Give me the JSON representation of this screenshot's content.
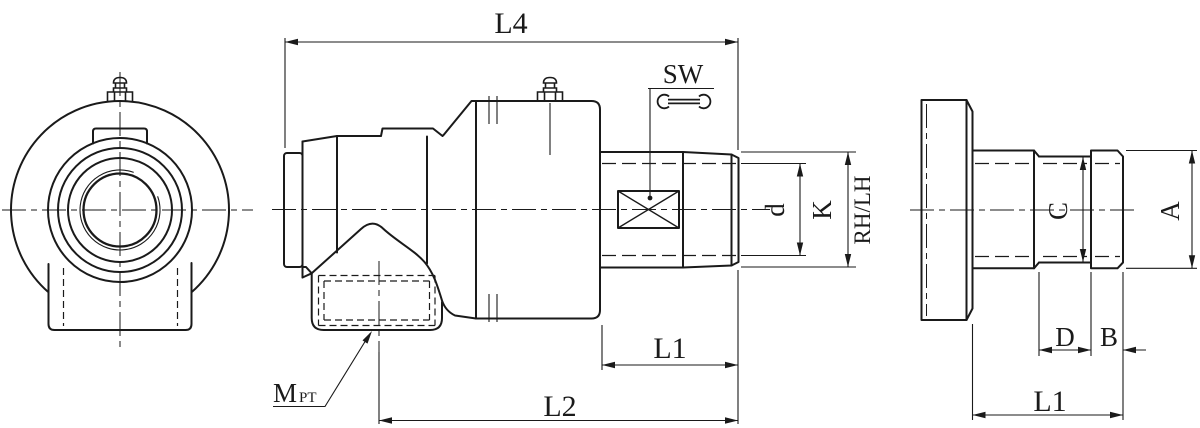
{
  "drawing": {
    "type": "engineering-drawing",
    "subject": "rotary joint with threaded shaft, front view, side view and nipple end view",
    "background_color": "#ffffff",
    "line_color": "#1a1a1a",
    "labels": {
      "l4": "L4",
      "sw": "SW",
      "d_small": "d",
      "k": "K",
      "rh_lh": "RH/LH",
      "l1_side": "L1",
      "l2": "L2",
      "m": "M",
      "m_sub": "PT",
      "c": "C",
      "a": "A",
      "d_big": "D",
      "b": "B",
      "l1_end": "L1"
    },
    "icons": {
      "wrench": "open-end-wrench marks SW flats",
      "x_box": "wrench-flat marker on shaft",
      "grease_nipple": "lubrication fitting on housing top"
    }
  }
}
